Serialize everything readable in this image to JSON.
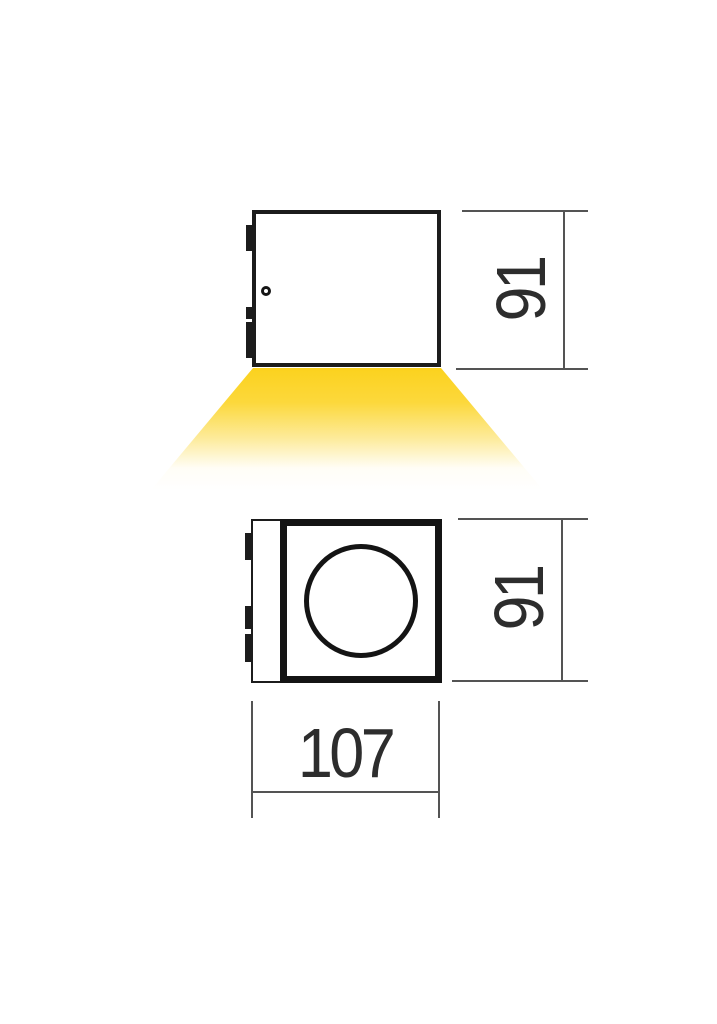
{
  "drawing": {
    "kind": "technical dimension drawing",
    "front_view": {
      "height_dim": "91"
    },
    "bottom_view": {
      "height_dim": "91",
      "width_dim": "107"
    },
    "colors": {
      "background": "#ffffff",
      "outline": "#1c1c1c",
      "dimension_line": "#545454",
      "dimension_text": "#2d2d2d",
      "beam_yellow": "#fbd21e"
    }
  }
}
